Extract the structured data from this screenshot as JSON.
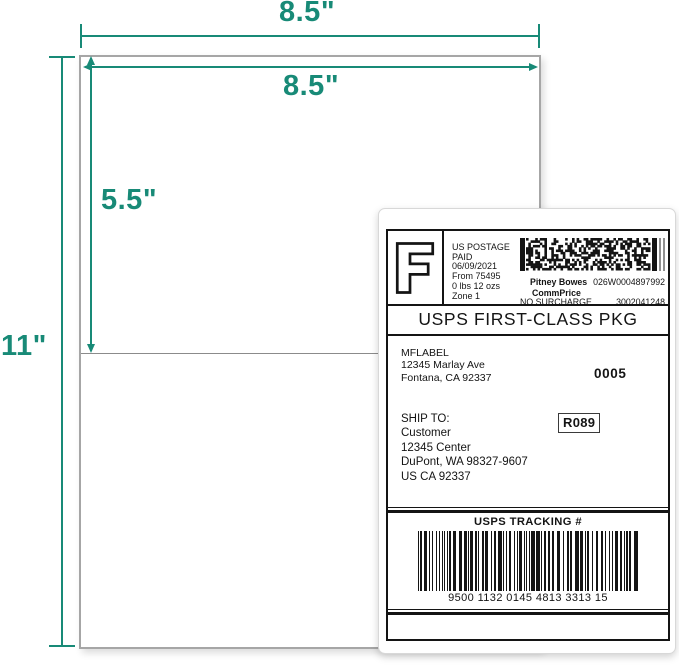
{
  "colors": {
    "accent_teal": "#188a77",
    "label_ink": "#141414"
  },
  "dimensions": {
    "sheet_width": "8.5\"",
    "label_width": "8.5\"",
    "label_height": "5.5\"",
    "sheet_height": "11\""
  },
  "shipping_label": {
    "postage_block": {
      "indicia_letter": "F",
      "line1": "US POSTAGE",
      "line2": "PAID",
      "line3": "06/09/2021",
      "line4": "From 75495",
      "line5": "0 lbs 12 ozs",
      "line6": "Zone 1"
    },
    "meter_block": {
      "carrier": "Pitney Bowes",
      "meter_number": "026W0004897992",
      "rate_name": "CommPrice",
      "surcharge": "NO SURCHARGE",
      "serial": "3002041248"
    },
    "service_banner": "USPS FIRST-CLASS PKG",
    "sender": {
      "name": "MFLABEL",
      "street": "12345 Marlay Ave",
      "city": "Fontana, CA 92337"
    },
    "batch_number": "0005",
    "ship_to": {
      "heading": "SHIP TO:",
      "name": "Customer",
      "street": "12345 Center",
      "city": "DuPont, WA 98327-9607",
      "country": "US CA 92337"
    },
    "route_code": "R089",
    "tracking": {
      "heading": "USPS TRACKING #",
      "number": "9500 1132 0145 4813 3313 15"
    }
  }
}
